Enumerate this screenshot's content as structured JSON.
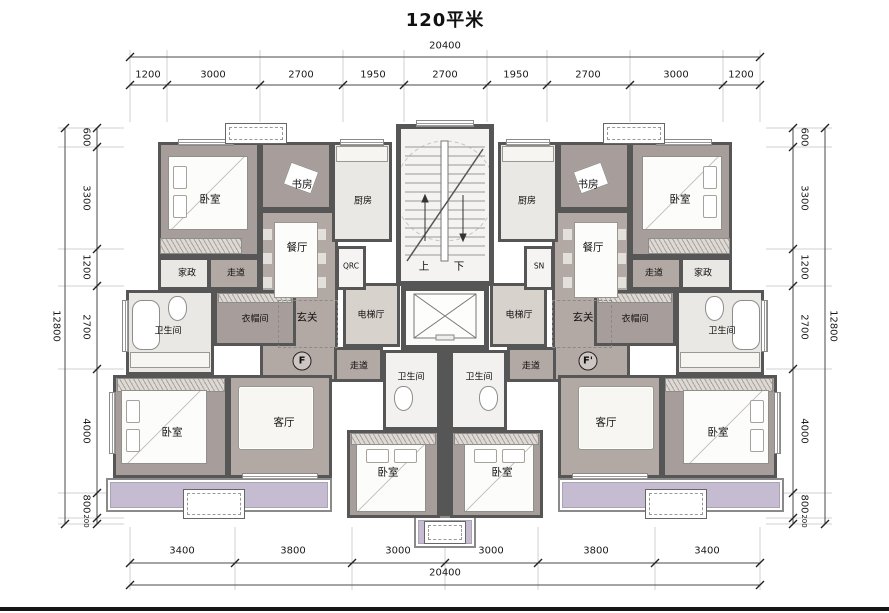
{
  "title": "120平米",
  "unit_marks": {
    "left": "F",
    "right": "F'"
  },
  "shafts": {
    "left": "QRC",
    "right": "SN"
  },
  "stairs": {
    "up": "上",
    "down": "下"
  },
  "rooms": {
    "bedroom": "卧室",
    "study": "书房",
    "kitchen": "厨房",
    "dining": "餐厅",
    "housekeeping": "家政",
    "corridor": "走道",
    "bathroom": "卫生间",
    "cloakroom": "衣帽间",
    "foyer": "玄关",
    "elevator_hall": "电梯厅",
    "living": "客厅"
  },
  "dims": {
    "top": {
      "total": "20400",
      "segments": [
        "1200",
        "3000",
        "2700",
        "1950",
        "2700",
        "1950",
        "2700",
        "3000",
        "1200"
      ]
    },
    "bottom": {
      "total": "20400",
      "segments": [
        "3400",
        "3800",
        "3000",
        "3000",
        "3800",
        "3400"
      ]
    },
    "left": {
      "total": "12800",
      "segments": [
        "600",
        "3300",
        "1200",
        "2700",
        "4000",
        "800",
        "200"
      ]
    },
    "right": {
      "total": "12800",
      "segments": [
        "600",
        "3300",
        "1200",
        "2700",
        "4000",
        "800",
        "200"
      ]
    }
  },
  "colors": {
    "wall": "#565656",
    "floor_open": "#b2a8a4",
    "floor_bedroom": "#a79d9b",
    "floor_wet": "#eae8e5",
    "balcony": "#c5bcd1",
    "elevator_hall_floor": "#d8d2cc"
  }
}
